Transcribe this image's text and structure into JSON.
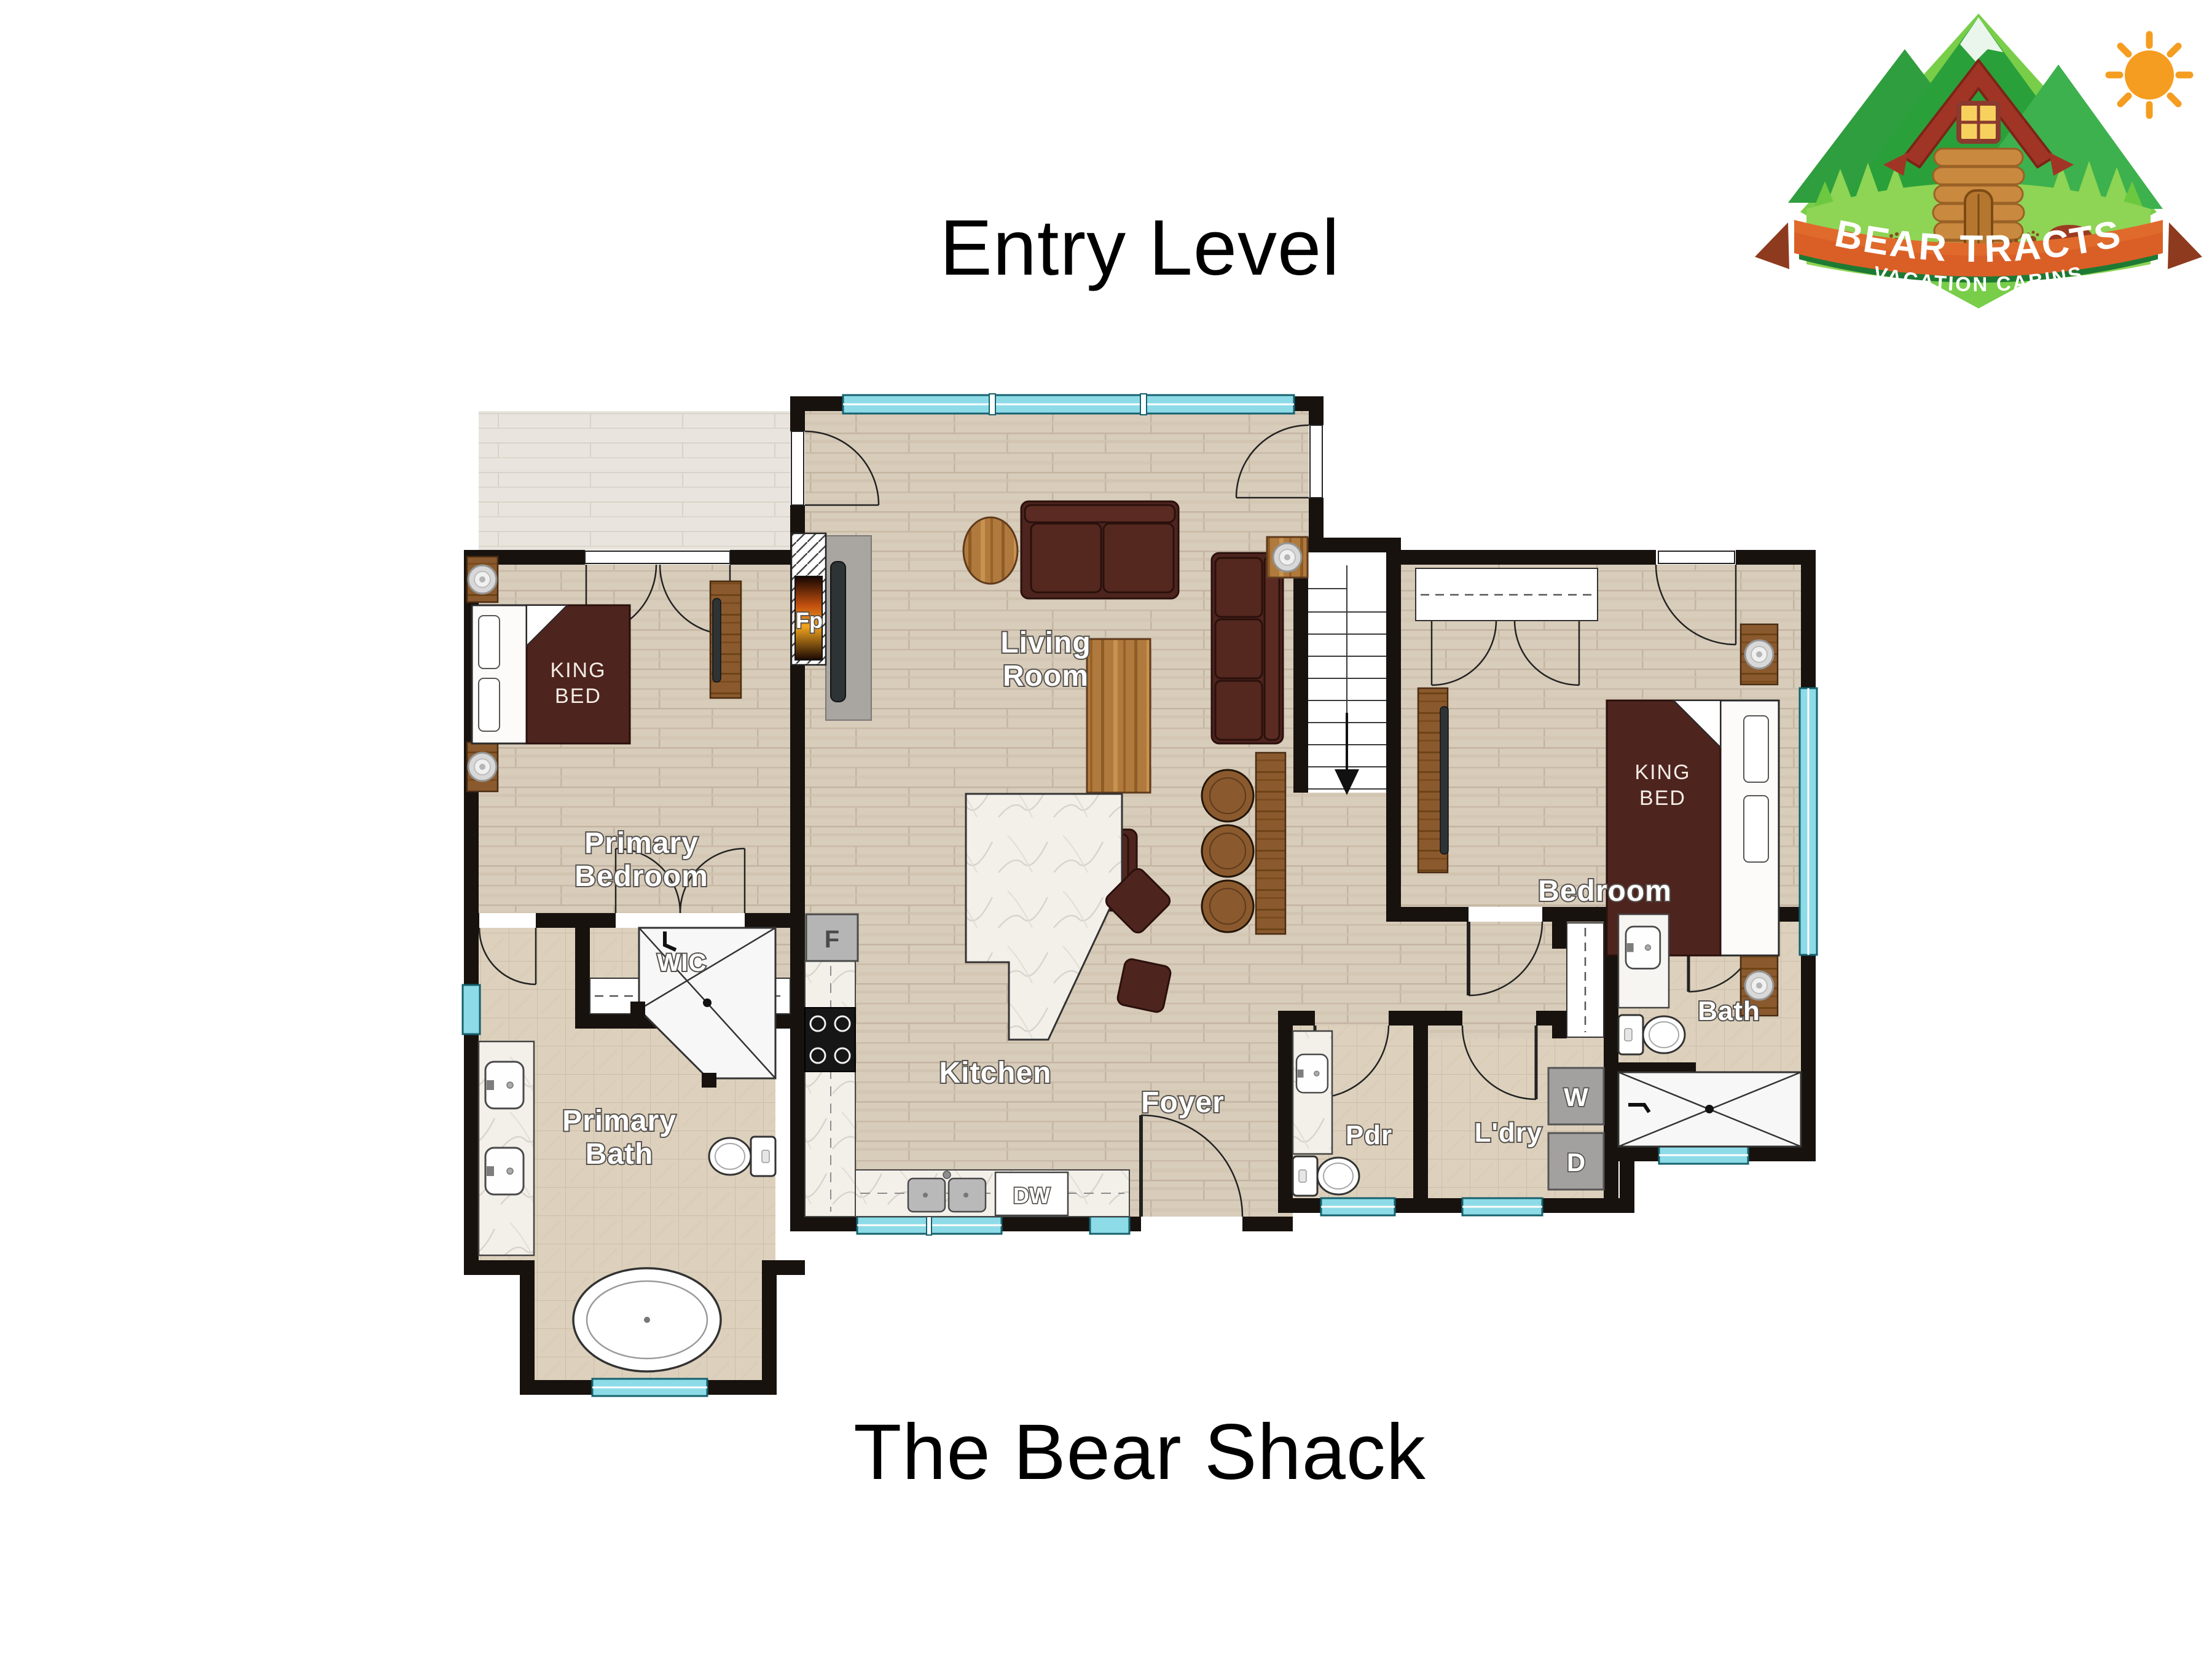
{
  "page": {
    "floor_title": "Entry Level",
    "property_title": "The Bear Shack"
  },
  "logo": {
    "name": "BEAR TRACTS",
    "tagline": "VACATION CABINS"
  },
  "rooms": {
    "living": {
      "l1": "Living",
      "l2": "Room"
    },
    "primary_bedroom": {
      "l1": "Primary",
      "l2": "Bedroom"
    },
    "primary_bath": {
      "l1": "Primary",
      "l2": "Bath"
    },
    "wic": "WIC",
    "kitchen": "Kitchen",
    "foyer": "Foyer",
    "powder": "Pdr",
    "laundry": "L'dry",
    "bath": "Bath",
    "bedroom": "Bedroom"
  },
  "furniture": {
    "king_bed": {
      "l1": "KING",
      "l2": "BED"
    }
  },
  "appliances": {
    "fireplace": "Fp",
    "fridge": "F",
    "dishwasher": "DW",
    "washer": "W",
    "dryer": "D"
  },
  "colors": {
    "wall": "#17120e",
    "window": "#8edbe8",
    "wood_floor": "#d8ccba",
    "tile_floor": "#ddd1bd",
    "marble": "#f3f0ea",
    "dark_furniture": "#4e241e",
    "wood_furniture": "#b07a3e",
    "logo_green": "#2aa03a",
    "logo_banner_orange": "#d95f27",
    "sun_orange": "#f59d20"
  }
}
